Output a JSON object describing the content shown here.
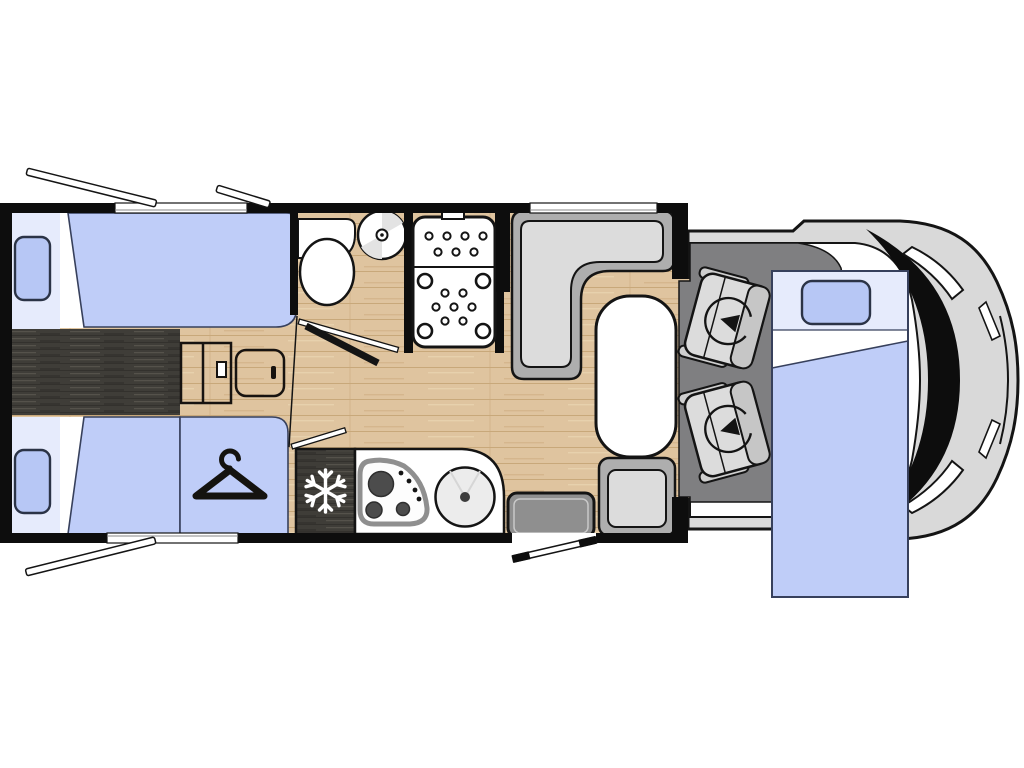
{
  "canvas": {
    "width": 1024,
    "height": 768,
    "background": "#ffffff"
  },
  "colors": {
    "wall": "#0d0d0d",
    "line": "#141414",
    "wood_base": "#dfc49f",
    "wood_line": "#c8a87a",
    "darkwood": "#3f3d38",
    "darkwood_line": "#55524b",
    "bed_blue": "#bfcdf8",
    "bed_head": "#e6ebfc",
    "pillow_blue": "#b7c7f5",
    "bed_outline": "#37405c",
    "cab_floor": "#7f7f81",
    "bench_gray": "#aeaeae",
    "cushion_gray": "#dcdcdc",
    "seat_gray": "#dcdcdc",
    "seat_band": "#c6c6c6",
    "armrest_gray": "#cfcfcf",
    "step_gray": "#8f8f8f",
    "step_inner": "#c9c9c9",
    "body_gray": "#d9d9d9",
    "sink_gray": "#ececec",
    "hob_gray": "#8f8f8f",
    "burner_dark": "#4c4c4c",
    "shade_gray": "#e3e3e3",
    "white": "#ffffff"
  },
  "floorplan": {
    "type": "motorhome-floorplan-top-view",
    "zones": [
      {
        "id": "rear-bedroom",
        "features": [
          "single-bed-top",
          "single-bed-bottom",
          "center-walkway",
          "bedside-steps",
          "bedside-cabinet",
          "wardrobe"
        ]
      },
      {
        "id": "bathroom",
        "features": [
          "vanity",
          "toilet",
          "washbasin",
          "shower-cabin"
        ]
      },
      {
        "id": "kitchen",
        "features": [
          "refrigerator",
          "three-burner-hob",
          "round-sink",
          "worktop"
        ]
      },
      {
        "id": "dinette",
        "features": [
          "l-shaped-bench",
          "oval-table",
          "side-seat"
        ]
      },
      {
        "id": "entrance",
        "features": [
          "entry-step",
          "entry-door-open"
        ]
      },
      {
        "id": "cab",
        "features": [
          "driver-swivel-seat",
          "passenger-swivel-seat",
          "drop-down-bed",
          "windshield",
          "headlights"
        ]
      }
    ],
    "windows": [
      {
        "id": "bedroom-window-top",
        "state": "open"
      },
      {
        "id": "bedroom-window-top-2",
        "state": "open"
      },
      {
        "id": "bedroom-window-bottom",
        "state": "open"
      },
      {
        "id": "dinette-window",
        "state": "closed"
      }
    ],
    "icons": [
      {
        "name": "snowflake-icon",
        "meaning": "refrigerator / freezer"
      },
      {
        "name": "hanger-icon",
        "meaning": "wardrobe"
      },
      {
        "name": "swivel-arrow-icon",
        "meaning": "rotating cab seat"
      },
      {
        "name": "door-swing-icon",
        "meaning": "open door"
      }
    ]
  }
}
